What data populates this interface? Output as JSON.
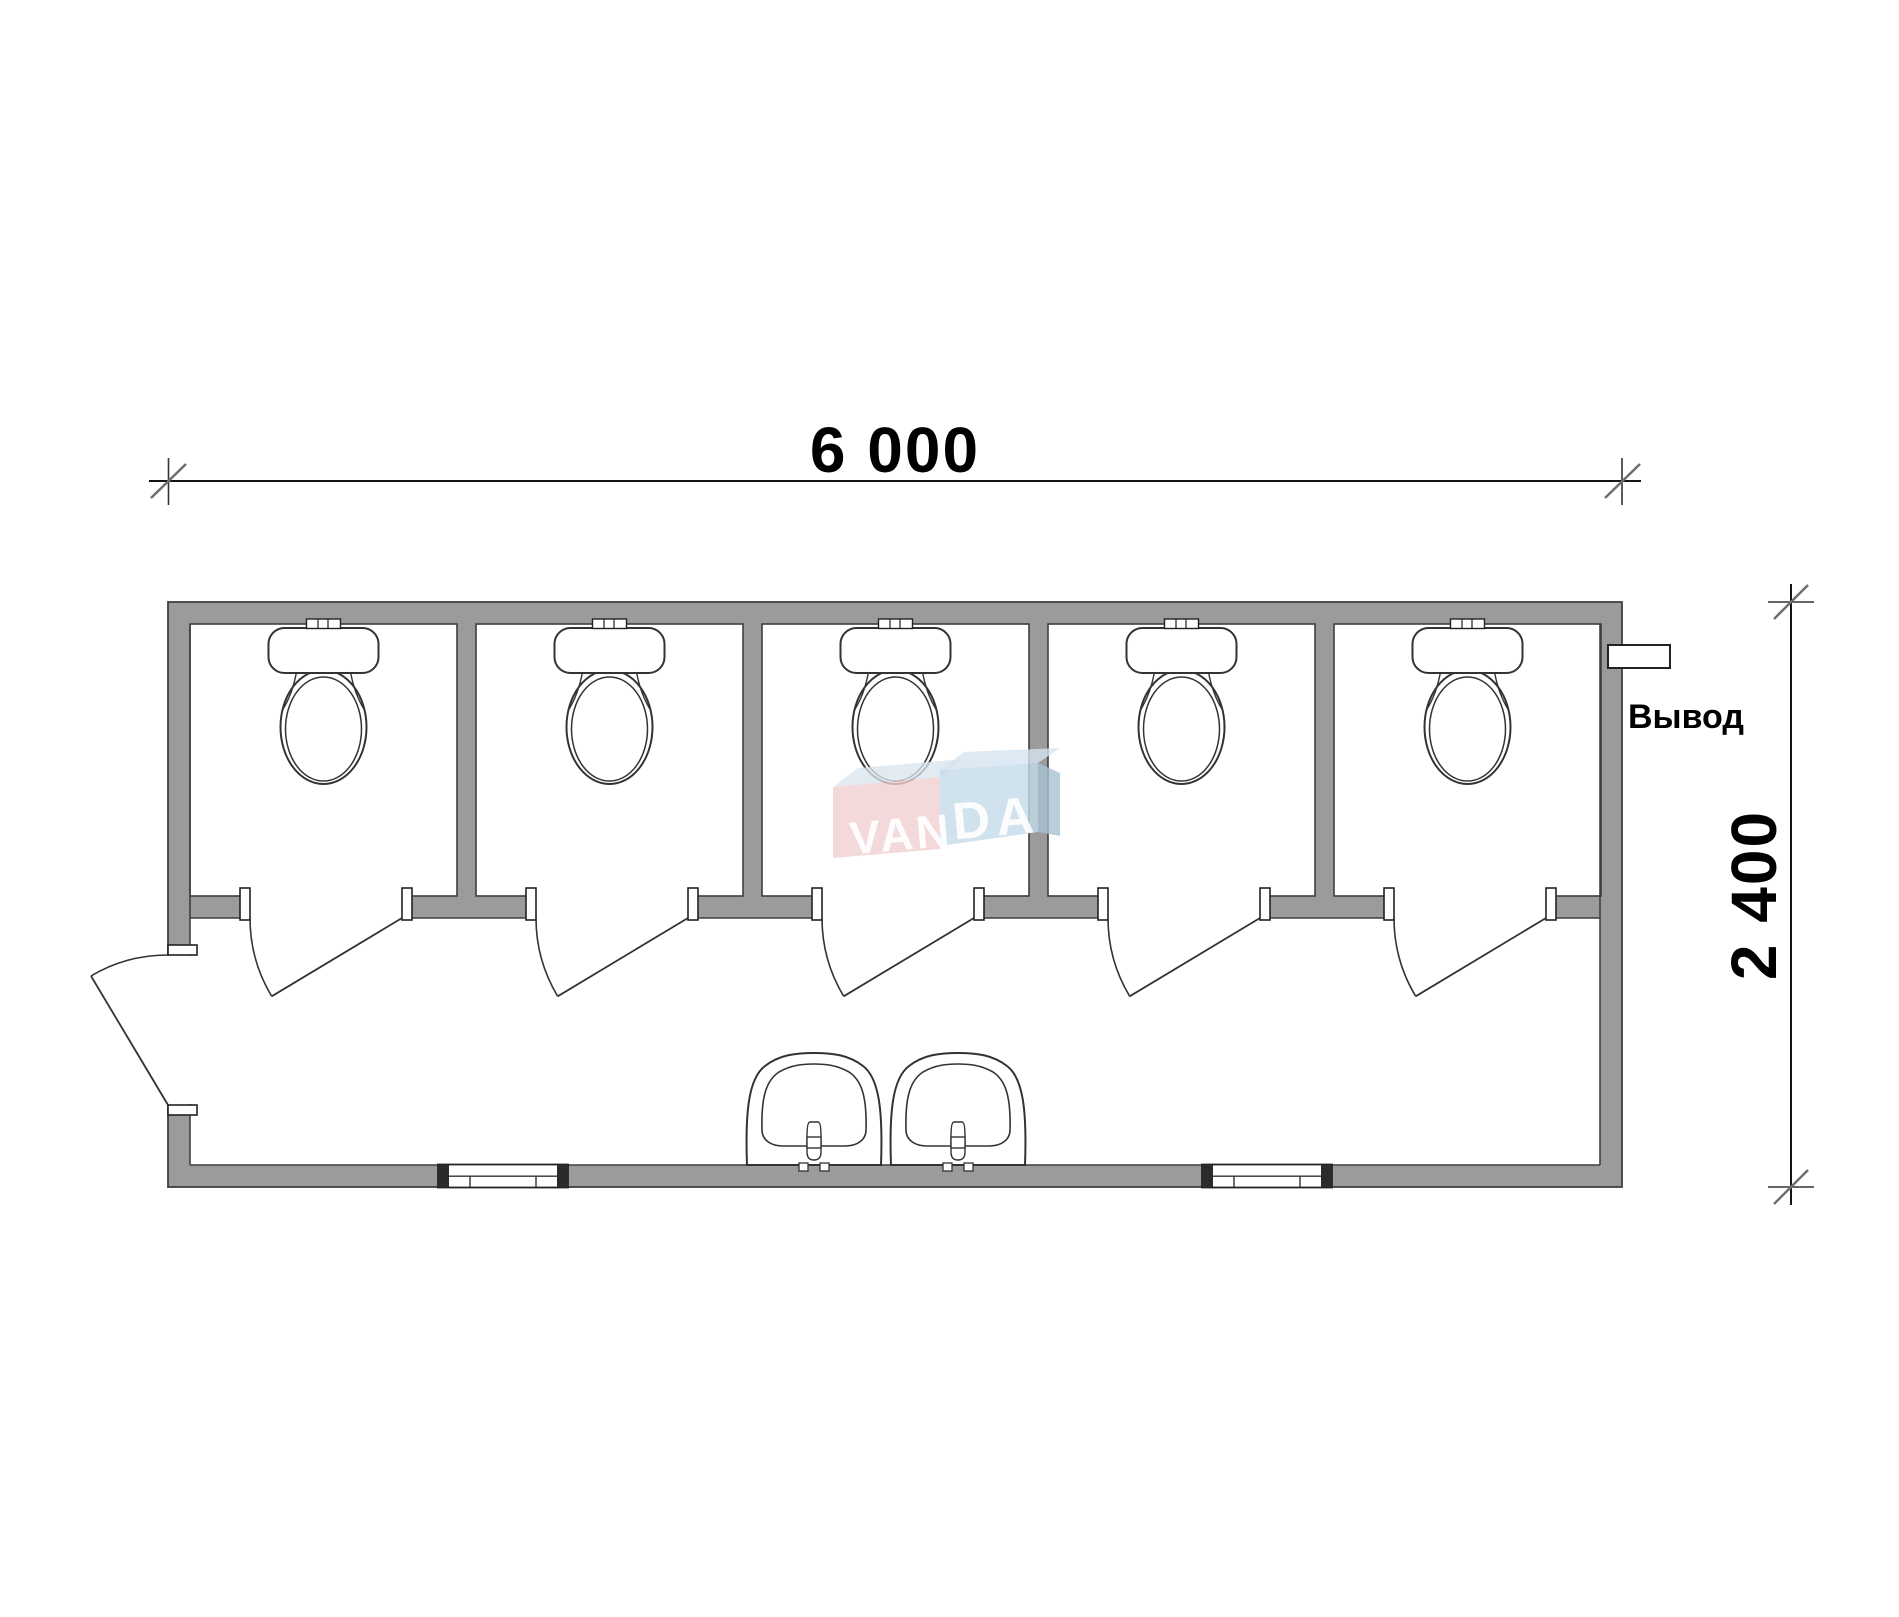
{
  "document": {
    "type": "sanitary-container-floor-plan",
    "background": "#ffffff"
  },
  "labels": {
    "width": "6 000",
    "height": "2 400",
    "outlet": "Вывод"
  },
  "watermark": {
    "left": "VAN",
    "right": "DA"
  },
  "colors": {
    "wall": "#9b9b9b",
    "outline": "#3f3f3f",
    "dim": "#141414",
    "tick": "#6e6e6e",
    "fixture": "#333333",
    "watermark_pink": "#f0cfcf",
    "watermark_pink_top": "#dbe5ee",
    "watermark_blue": "#c6dbeb",
    "watermark_blue_top": "#d5e4f0",
    "watermark_blue_side": "#a9c0d2"
  },
  "plan": {
    "stalls": 5,
    "toilets": 5,
    "sinks": 2,
    "windows": 2,
    "stall_doors": 5,
    "exterior_doors": 1
  }
}
